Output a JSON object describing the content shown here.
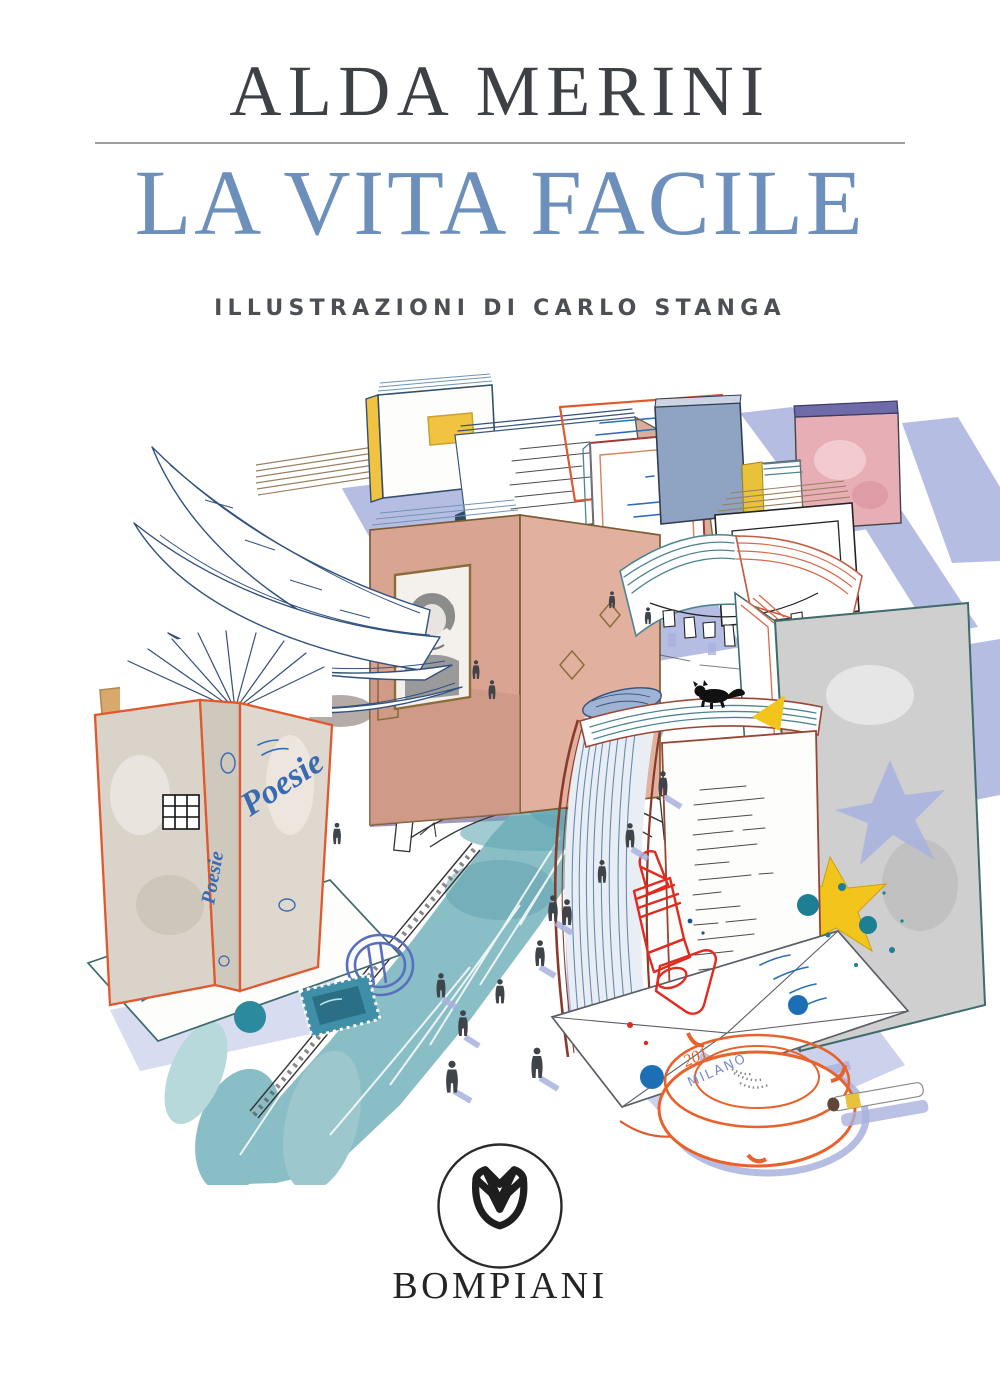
{
  "page": {
    "width": 1000,
    "height": 1380,
    "background": "#ffffff"
  },
  "header": {
    "author": "ALDA MERINI",
    "title": "LA VITA FACILE",
    "credit": "ILLUSTRAZIONI DI CARLO STANGA"
  },
  "publisher": {
    "name": "BOMPIANI",
    "logo_icon": "bompiani-flower-icon"
  },
  "illustration": {
    "texts": {
      "poesie_cover": "Poesie",
      "poesie_spine": "Poesie",
      "ashtray_year": "201",
      "ashtray_city": "MILANO"
    },
    "palette": {
      "title_blue": "#6d8fbc",
      "author_gray": "#3d4146",
      "credit_gray": "#4c5055",
      "rule_gray": "#9e9e9e",
      "logo_black": "#1e1e1e",
      "canal_teal": "#8abec6",
      "shadow_periwinkle": "#a9b2de",
      "book_salmon": "#dba896",
      "book_blue": "#6e93b8",
      "accent_orange": "#e0592e",
      "lipstick_red": "#e02b20",
      "star_yellow": "#f2c41c",
      "ink_navy": "#35507a",
      "splatter_teal": "#1d7f93"
    },
    "elements": [
      "winged-open-book",
      "book-building-row",
      "portrait-window-book",
      "alda-merini-portrait",
      "navigli-canal",
      "arched-iron-bridge",
      "canal-railing",
      "pedestrian-silhouettes",
      "clothesline-laundry-book",
      "waterfall-pages-book",
      "poem-page-book",
      "black-cat",
      "yellow-star",
      "poesie-book",
      "bookmark",
      "postcard-with-stamp",
      "postmark",
      "lipstick",
      "letter-envelope",
      "ashtray",
      "cigarette",
      "ink-splatters"
    ]
  }
}
